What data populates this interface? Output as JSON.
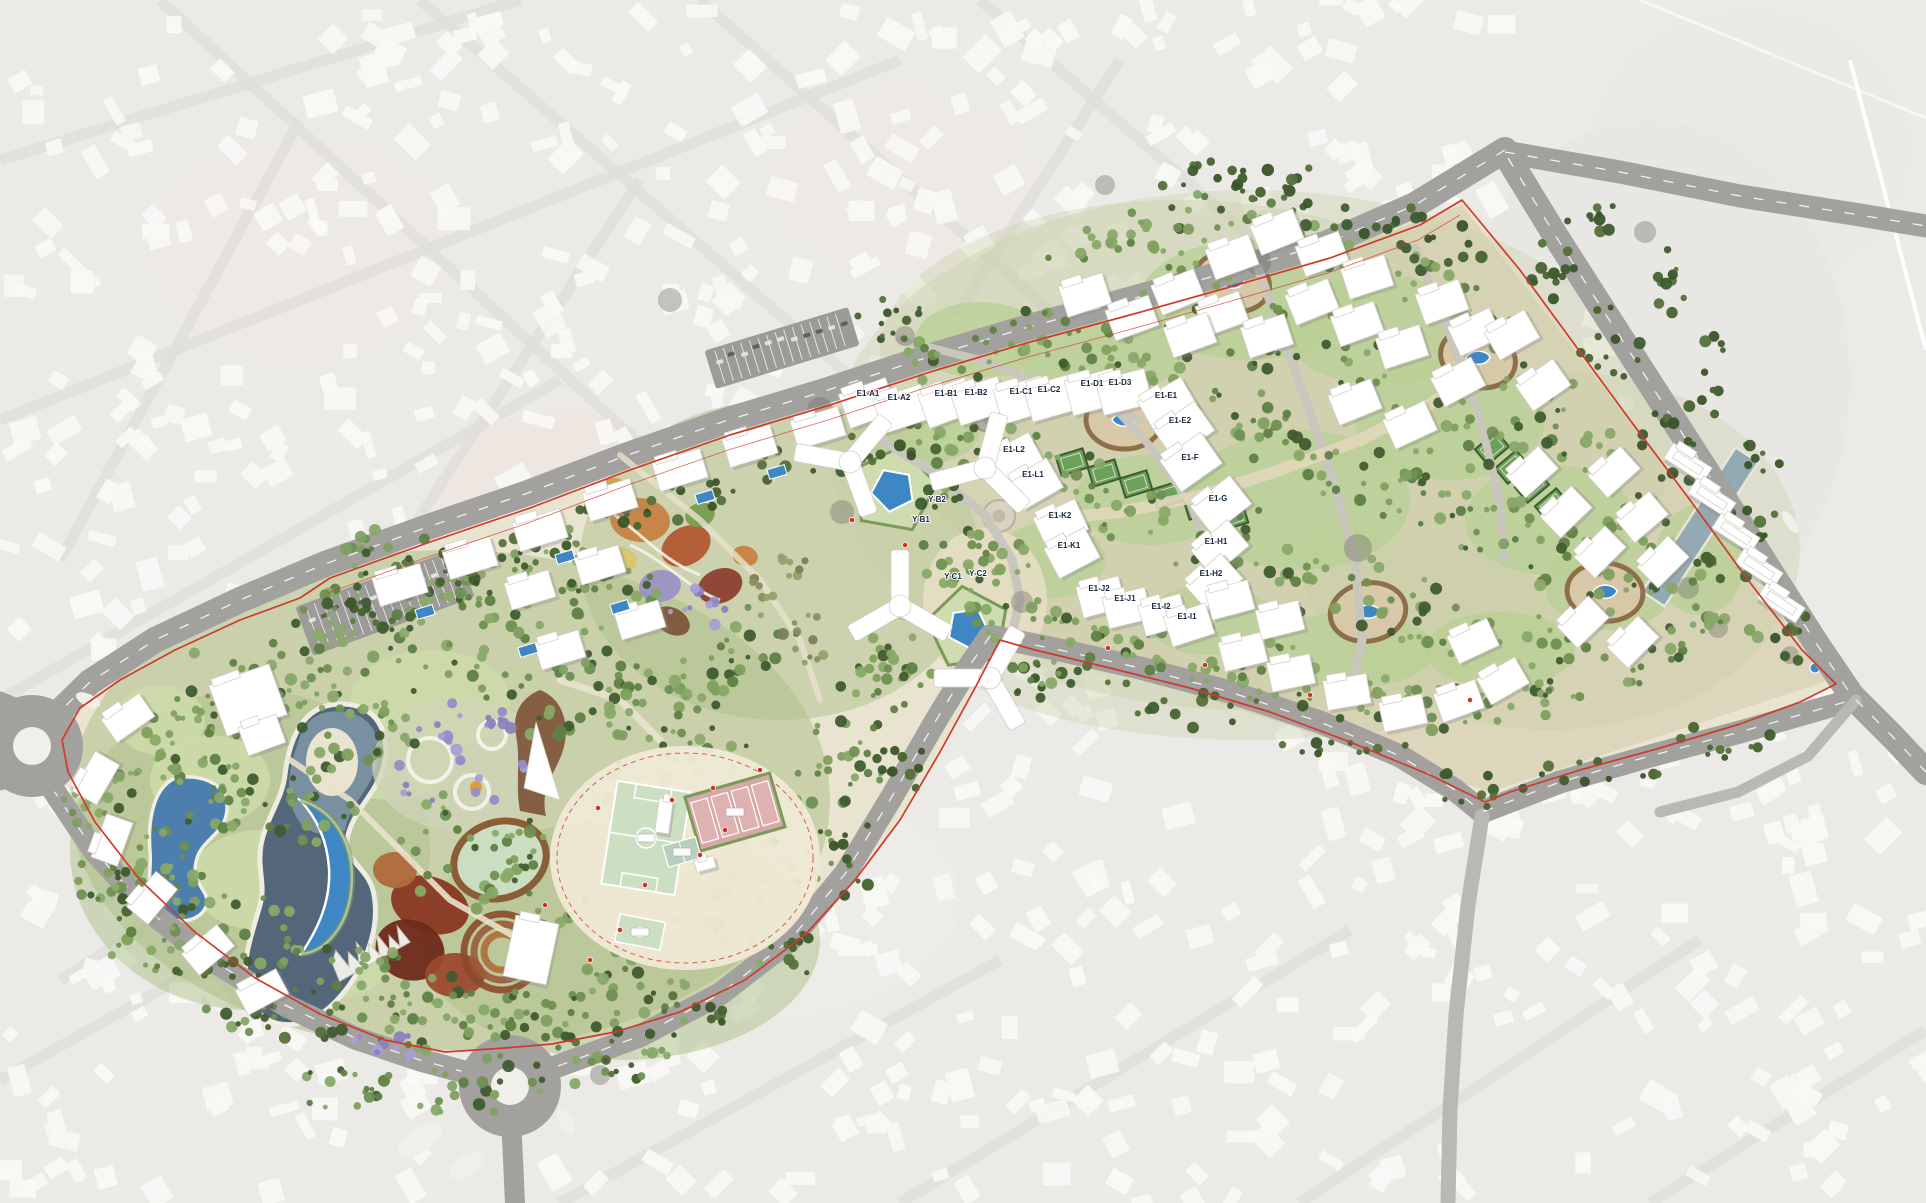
{
  "map": {
    "kind": "residential-masterplan-siteplan",
    "canvas": {
      "width": 1926,
      "height": 1203
    },
    "plot_labels": [
      {
        "label": "E1-A1",
        "x": 868,
        "y": 396
      },
      {
        "label": "E1-A2",
        "x": 899,
        "y": 400
      },
      {
        "label": "E1-B1",
        "x": 946,
        "y": 396
      },
      {
        "label": "E1-B2",
        "x": 976,
        "y": 395
      },
      {
        "label": "E1-C1",
        "x": 1021,
        "y": 394
      },
      {
        "label": "E1-C2",
        "x": 1049,
        "y": 392
      },
      {
        "label": "E1-D1",
        "x": 1092,
        "y": 386
      },
      {
        "label": "E1-D3",
        "x": 1120,
        "y": 385
      },
      {
        "label": "E1-E1",
        "x": 1166,
        "y": 398
      },
      {
        "label": "E1-E2",
        "x": 1180,
        "y": 423
      },
      {
        "label": "E1-L2",
        "x": 1014,
        "y": 452
      },
      {
        "label": "E1-L1",
        "x": 1033,
        "y": 477
      },
      {
        "label": "E1-F",
        "x": 1190,
        "y": 460
      },
      {
        "label": "Y-B2",
        "x": 937,
        "y": 502
      },
      {
        "label": "Y-B1",
        "x": 921,
        "y": 522
      },
      {
        "label": "E1-K2",
        "x": 1060,
        "y": 518
      },
      {
        "label": "E1-G",
        "x": 1218,
        "y": 501
      },
      {
        "label": "E1-K1",
        "x": 1069,
        "y": 548
      },
      {
        "label": "E1-H1",
        "x": 1216,
        "y": 544
      },
      {
        "label": "E1-H2",
        "x": 1211,
        "y": 576
      },
      {
        "label": "Y-C1",
        "x": 953,
        "y": 579
      },
      {
        "label": "Y-C2",
        "x": 978,
        "y": 576
      },
      {
        "label": "E1-J2",
        "x": 1099,
        "y": 591
      },
      {
        "label": "E1-J1",
        "x": 1125,
        "y": 601
      },
      {
        "label": "E1-I2",
        "x": 1161,
        "y": 609
      },
      {
        "label": "E1-I1",
        "x": 1187,
        "y": 619
      }
    ],
    "colors": {
      "bg": "#eceae7",
      "bg_block": "#f8f8f5",
      "bg_street": "#e0deda",
      "site_ground": "#e8e4d0",
      "district_ground": "#dbd3b8",
      "plaza": "#e6dec4",
      "road": "#a2a19d",
      "road_minor": "#bab8b4",
      "road_dash": "#ffffff",
      "boundary_red": "#cf3a2e",
      "lake_dark": "#54677a",
      "lake_light": "#7d95a4",
      "pond_blue": "#4d7fae",
      "pool_blue": "#3e87c4",
      "canal": "#93aab2",
      "tree_dark": "#3f5c30",
      "tree_mid": "#5f7f44",
      "tree_light": "#7fa05e",
      "tree_pale": "#8aa96a",
      "tree_purple": "#958dc6",
      "tree_olive": "#7a7f56",
      "lawn": "#b9cf96",
      "meadow": "#cdd9a8",
      "field_green": "#ccdfc3",
      "court_pink": "#dfb2b2",
      "court_teal": "#b8cfc0",
      "building": "#ffffff",
      "building_edge": "#d2d0c8",
      "shadow": "#8b8b84",
      "play_orange": "#c77f3e",
      "play_red": "#8a3c2a",
      "play_purple": "#9b8fc4",
      "play_yellow": "#d8c66a",
      "desert_red": "#7e3120",
      "wadi_brown": "#7d5236",
      "rock_tan": "#d9c9a8",
      "rock_edge": "#8a6a44",
      "marker_red": "#d03028",
      "parking": "#9c9b97"
    }
  }
}
